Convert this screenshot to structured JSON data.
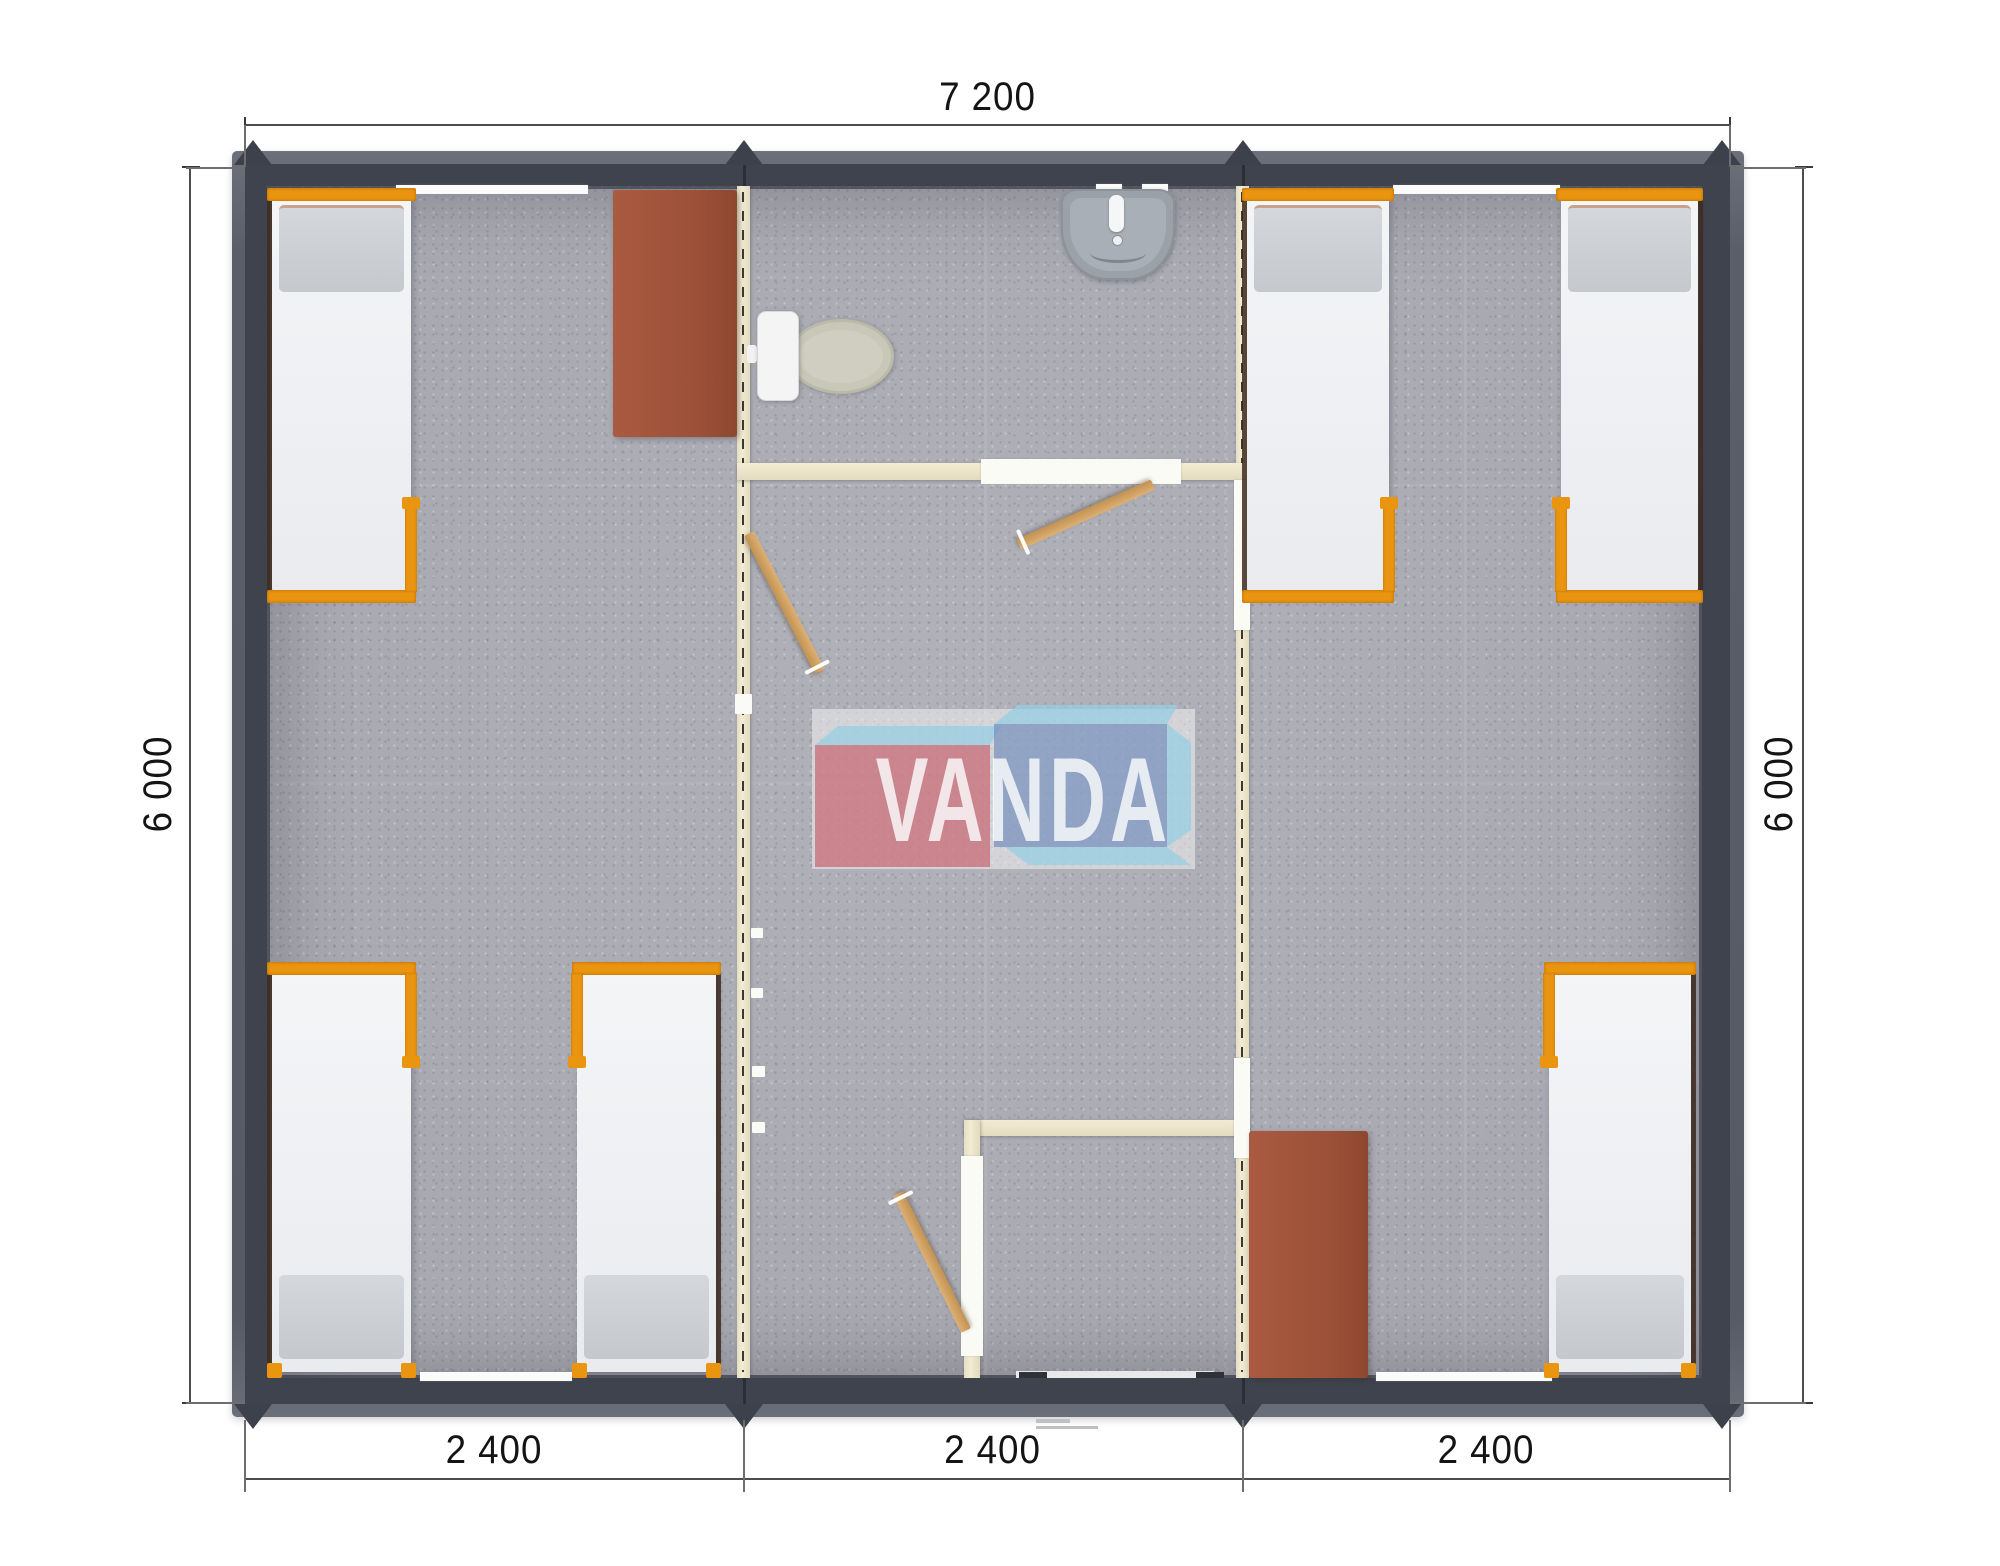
{
  "page": {
    "type": "architectural floor plan (top-view render) of a 3-module container house",
    "background": "#ffffff"
  },
  "dimensions": {
    "top": "7 200",
    "left": "6 000",
    "right": "6 000",
    "bottom": [
      "2 400",
      "2 400",
      "2 400"
    ]
  },
  "watermark": {
    "text": "VANDA",
    "red": "#c65c67",
    "blue": "#6886b8",
    "light_blue": "#94cee3"
  },
  "palette": {
    "wall": "#3f434d",
    "roof_edge": "#636771",
    "floor_carpet": "#a9a9b2",
    "partition_wood": "#efe8ce",
    "bed_frame_orange": "#ea950f",
    "mattress_white": "#f1f2f4",
    "pillow_gray": "#ccd0d4",
    "desk_brown": "#a1543b",
    "door_wood": "#d0a263",
    "toilet_bowl": "#c9c8b8",
    "sink_gray": "#9aa1a9"
  },
  "symbols": [
    "bed",
    "desk",
    "toilet",
    "sink",
    "door-leaf",
    "window",
    "entrance-door",
    "module-joint-marker"
  ]
}
